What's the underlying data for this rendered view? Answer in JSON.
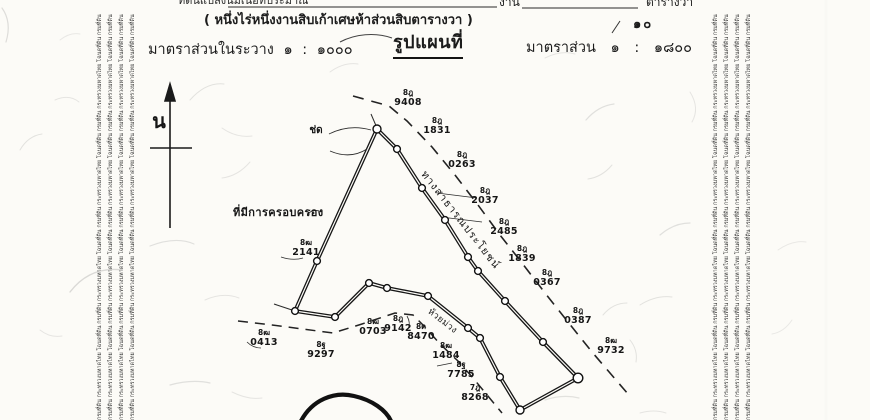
{
  "document": {
    "area_line": {
      "prefix": "ที่ดินแปลงนี้มีเนื้อที่ประมาณ",
      "ngan_label": "งาน",
      "wa_label": "ตารางวา",
      "wa_value": "๑๐"
    },
    "area_text": "( หนึ่งไร่หนึ่งงานสิบเก้าเศษห้าส่วนสิบตารางวา )",
    "scale_in_sheet": "มาตราส่วนในระวาง ๑ : ๑๐๐๐",
    "map_title": "รูปแผนที่",
    "map_scale": "มาตราส่วน ๑ : ๑๘๐๐"
  },
  "map": {
    "north_label": "น",
    "possession_label": "ที่มีการครอบครอง",
    "road_label": "ทางสาธารณประโยชน์",
    "stream_label": "ห้วยม่วง",
    "apex_label": "ช่ด",
    "markers": [
      {
        "p": "8ฎ",
        "n": "9408"
      },
      {
        "p": "8ฎ",
        "n": "1831"
      },
      {
        "p": "8ฎ",
        "n": "0263"
      },
      {
        "p": "8ฎ",
        "n": "2037"
      },
      {
        "p": "8ฎ",
        "n": "2485"
      },
      {
        "p": "8ฎ",
        "n": "1839"
      },
      {
        "p": "8ฎ",
        "n": "0367"
      },
      {
        "p": "8ฎ",
        "n": "0387"
      },
      {
        "p": "8ฒ",
        "n": "9732"
      },
      {
        "p": "8ฒ",
        "n": "2141"
      },
      {
        "p": "8ฒ",
        "n": "0413"
      },
      {
        "p": "8ฐ",
        "n": "9297"
      },
      {
        "p": "8ฒ",
        "n": "0703"
      },
      {
        "p": "8ฎ",
        "n": "9142"
      },
      {
        "p": "8ด",
        "n": "8470"
      },
      {
        "p": "8ฒ",
        "n": "1484"
      },
      {
        "p": "8ฐ",
        "n": "7785"
      },
      {
        "p": "7ฎ",
        "n": "8268"
      }
    ]
  },
  "margins": {
    "security_text": "กรมที่ดิน กระทรวงมหาดไทย โฉนดที่ดิน"
  },
  "colors": {
    "ink": "#1c1c1c",
    "paper": "#fcfbf7"
  }
}
